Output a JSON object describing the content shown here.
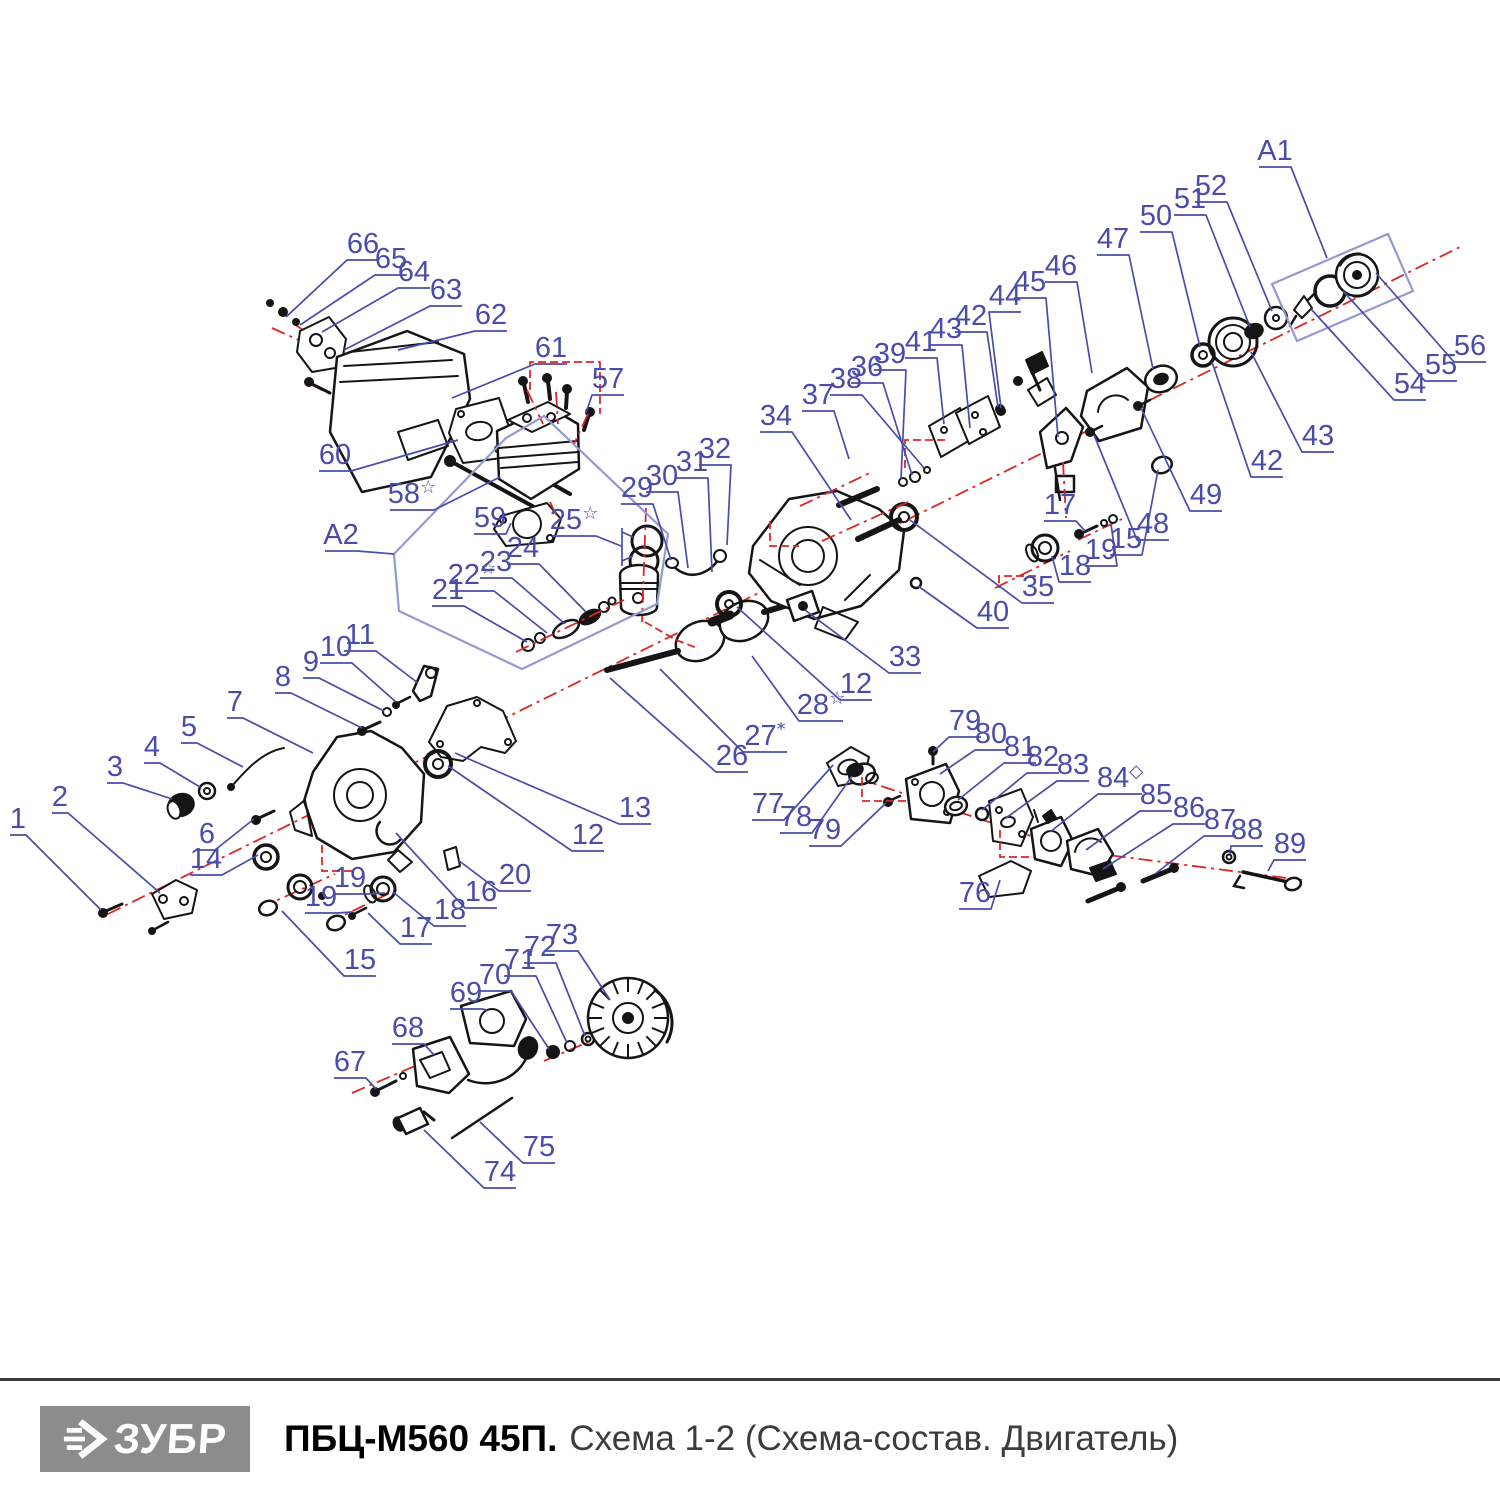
{
  "footer": {
    "brand": "ЗУБР",
    "model": "ПБЦ-М560 45П.",
    "subtitle": "Схема 1-2 (Схема-состав. Двигатель)"
  },
  "diagram": {
    "colors": {
      "label": "#4a4caa",
      "leader": "#4a4caa",
      "assembly_box": "#9599d2",
      "axis_red": "#dc2626",
      "ink": "#151515",
      "logo_bg": "#8c8c8c",
      "subtitle_gray": "#3c3c3c"
    },
    "assembly_boxes": [
      {
        "label": "A1",
        "points": "1272,284 1388,234 1413,291 1297,341"
      },
      {
        "label": "A2",
        "points": "394,554 506,438 544,416 668,534 657,604 522,669 399,611"
      }
    ],
    "axes_under": [
      "108,914 1460,247",
      "294,324 516,470",
      "272,328 336,357",
      "310,384 354,406",
      "830,769 1070,849",
      "1085,852 1302,880",
      "544,1061 667,1008",
      "352,1093 450,1051",
      "260,908 335,874",
      "328,923 400,888",
      "995,588 1070,551",
      "1078,540 1122,519"
    ],
    "axes_over": [
      "527,390 543,424",
      "556,392 558,424",
      "588,414 574,444",
      "646,508 642,622",
      "550,502 562,527",
      "516,652 624,600",
      "800,506 872,472",
      "822,541 908,502",
      "1063,462 1066,518"
    ],
    "connectors": [
      "530,390 530,362 600,362 600,414",
      "862,777 862,801 906,801",
      "1000,830 1000,857 1034,857",
      "322,845 322,871 352,871",
      "1036,576 999,576 999,588",
      "770,521 770,546 799,546",
      "645,622 676,640 697,648",
      "905,468 905,440 948,440"
    ],
    "extra_leaders": [
      "622,528 622,566",
      "622,532 633,537",
      "622,561 633,556"
    ],
    "callouts": [
      {
        "t": "1",
        "x": 18,
        "y": 828,
        "tx": 101,
        "ty": 910
      },
      {
        "t": "2",
        "x": 60,
        "y": 806,
        "tx": 160,
        "ty": 893
      },
      {
        "t": "3",
        "x": 115,
        "y": 776,
        "tx": 172,
        "ty": 799
      },
      {
        "t": "4",
        "x": 152,
        "y": 756,
        "tx": 200,
        "ty": 787
      },
      {
        "t": "5",
        "x": 189,
        "y": 736,
        "tx": 243,
        "ty": 767
      },
      {
        "t": "6",
        "x": 207,
        "y": 843,
        "tx": 254,
        "ty": 819
      },
      {
        "t": "7",
        "x": 235,
        "y": 711,
        "tx": 313,
        "ty": 753
      },
      {
        "t": "8",
        "x": 283,
        "y": 686,
        "tx": 362,
        "ty": 728
      },
      {
        "t": "9",
        "x": 311,
        "y": 671,
        "tx": 384,
        "ty": 711
      },
      {
        "t": "10",
        "x": 336,
        "y": 656,
        "tx": 396,
        "ty": 702
      },
      {
        "t": "11",
        "x": 360,
        "y": 644,
        "tx": 418,
        "ty": 683
      },
      {
        "t": "14",
        "x": 206,
        "y": 868,
        "tx": 258,
        "ty": 855
      },
      {
        "t": "15",
        "x": 360,
        "y": 969,
        "tx": 282,
        "ty": 911
      },
      {
        "t": "16",
        "x": 481,
        "y": 901,
        "tx": 396,
        "ty": 833
      },
      {
        "t": "17",
        "x": 416,
        "y": 937,
        "tx": 368,
        "ty": 913
      },
      {
        "t": "18",
        "x": 450,
        "y": 919,
        "tx": 393,
        "ty": 892
      },
      {
        "t": "19",
        "x": 350,
        "y": 887,
        "tx": 385,
        "ty": 893
      },
      {
        "t": "19",
        "x": 321,
        "y": 906,
        "tx": 352,
        "ty": 912
      },
      {
        "t": "20",
        "x": 515,
        "y": 884,
        "tx": 458,
        "ty": 860
      },
      {
        "t": "12",
        "x": 588,
        "y": 844,
        "tx": 448,
        "ty": 766
      },
      {
        "t": "13",
        "x": 635,
        "y": 817,
        "tx": 455,
        "ty": 753
      },
      {
        "t": "67",
        "x": 350,
        "y": 1071,
        "tx": 376,
        "ty": 1089
      },
      {
        "t": "68",
        "x": 408,
        "y": 1037,
        "tx": 434,
        "ty": 1055
      },
      {
        "t": "69",
        "x": 466,
        "y": 1002,
        "tx": 487,
        "ty": 1010
      },
      {
        "t": "70",
        "x": 495,
        "y": 984,
        "tx": 549,
        "ty": 1049
      },
      {
        "t": "71",
        "x": 520,
        "y": 969,
        "tx": 567,
        "ty": 1043
      },
      {
        "t": "72",
        "x": 540,
        "y": 956,
        "tx": 585,
        "ty": 1036
      },
      {
        "t": "73",
        "x": 562,
        "y": 944,
        "tx": 610,
        "ty": 1000
      },
      {
        "t": "74",
        "x": 500,
        "y": 1181,
        "tx": 424,
        "ty": 1130
      },
      {
        "t": "75",
        "x": 539,
        "y": 1156,
        "tx": 480,
        "ty": 1122
      },
      {
        "t": "66",
        "x": 363,
        "y": 253,
        "tx": 286,
        "ty": 317
      },
      {
        "t": "65",
        "x": 391,
        "y": 268,
        "tx": 300,
        "ty": 325
      },
      {
        "t": "64",
        "x": 414,
        "y": 281,
        "tx": 322,
        "ty": 332
      },
      {
        "t": "63",
        "x": 446,
        "y": 299,
        "tx": 344,
        "ty": 350
      },
      {
        "t": "62",
        "x": 491,
        "y": 324,
        "tx": 398,
        "ty": 350
      },
      {
        "t": "61",
        "x": 551,
        "y": 357,
        "tx": 452,
        "ty": 398
      },
      {
        "t": "57",
        "x": 608,
        "y": 388,
        "tx": 586,
        "ty": 413
      },
      {
        "t": "60",
        "x": 335,
        "y": 464,
        "tx": 458,
        "ty": 440
      },
      {
        "t": "58",
        "x": 412,
        "y": 503,
        "sfx": "☆",
        "tx": 500,
        "ty": 477
      },
      {
        "t": "59",
        "x": 490,
        "y": 527,
        "tx": 511,
        "ty": 523
      },
      {
        "t": "A2",
        "x": 341,
        "y": 544,
        "tx": 394,
        "ty": 554
      },
      {
        "t": "25",
        "x": 574,
        "y": 529,
        "sfx": "☆",
        "tx": 621,
        "ty": 546
      },
      {
        "t": "24",
        "x": 523,
        "y": 557,
        "tx": 586,
        "ty": 612
      },
      {
        "t": "23",
        "x": 496,
        "y": 571,
        "tx": 565,
        "ty": 624
      },
      {
        "t": "22",
        "x": 472,
        "y": 584,
        "sfx": "☆",
        "tx": 547,
        "ty": 633
      },
      {
        "t": "21",
        "x": 448,
        "y": 599,
        "tx": 527,
        "ty": 642
      },
      {
        "t": "29",
        "x": 637,
        "y": 497,
        "tx": 671,
        "ty": 560
      },
      {
        "t": "30",
        "x": 662,
        "y": 485,
        "tx": 688,
        "ty": 568
      },
      {
        "t": "31",
        "x": 692,
        "y": 471,
        "tx": 712,
        "ty": 572
      },
      {
        "t": "32",
        "x": 715,
        "y": 458,
        "tx": 727,
        "ty": 545
      },
      {
        "t": "34",
        "x": 776,
        "y": 425,
        "tx": 851,
        "ty": 520
      },
      {
        "t": "37",
        "x": 818,
        "y": 404,
        "tx": 849,
        "ty": 459
      },
      {
        "t": "38",
        "x": 846,
        "y": 388,
        "tx": 924,
        "ty": 468
      },
      {
        "t": "36",
        "x": 867,
        "y": 376,
        "tx": 912,
        "ty": 475
      },
      {
        "t": "39",
        "x": 890,
        "y": 363,
        "tx": 901,
        "ty": 479
      },
      {
        "t": "41",
        "x": 921,
        "y": 351,
        "tx": 944,
        "ty": 424
      },
      {
        "t": "43",
        "x": 946,
        "y": 338,
        "tx": 970,
        "ty": 428
      },
      {
        "t": "42",
        "x": 971,
        "y": 325,
        "tx": 998,
        "ty": 407
      },
      {
        "t": "44",
        "x": 1005,
        "y": 305,
        "tx": 1001,
        "ty": 408
      },
      {
        "t": "45",
        "x": 1030,
        "y": 291,
        "tx": 1058,
        "ty": 437
      },
      {
        "t": "46",
        "x": 1061,
        "y": 275,
        "tx": 1092,
        "ty": 373
      },
      {
        "t": "47",
        "x": 1113,
        "y": 248,
        "tx": 1153,
        "ty": 369
      },
      {
        "t": "50",
        "x": 1156,
        "y": 225,
        "tx": 1200,
        "ty": 347
      },
      {
        "t": "51",
        "x": 1190,
        "y": 208,
        "tx": 1250,
        "ty": 327
      },
      {
        "t": "52",
        "x": 1211,
        "y": 195,
        "tx": 1272,
        "ty": 311
      },
      {
        "t": "A1",
        "x": 1275,
        "y": 160,
        "tx": 1327,
        "ty": 258
      },
      {
        "t": "56",
        "x": 1470,
        "y": 355,
        "tx": 1376,
        "ty": 273
      },
      {
        "t": "55",
        "x": 1441,
        "y": 374,
        "tx": 1343,
        "ty": 291
      },
      {
        "t": "54",
        "x": 1410,
        "y": 393,
        "tx": 1311,
        "ty": 309
      },
      {
        "t": "43",
        "x": 1318,
        "y": 445,
        "tx": 1251,
        "ty": 352
      },
      {
        "t": "42",
        "x": 1267,
        "y": 470,
        "tx": 1212,
        "ty": 362
      },
      {
        "t": "49",
        "x": 1206,
        "y": 504,
        "tx": 1141,
        "ty": 408
      },
      {
        "t": "48",
        "x": 1153,
        "y": 533,
        "tx": 1094,
        "ty": 435
      },
      {
        "t": "15",
        "x": 1126,
        "y": 548,
        "tx": 1158,
        "ty": 470
      },
      {
        "t": "17",
        "x": 1060,
        "y": 514,
        "tx": 1085,
        "ty": 531
      },
      {
        "t": "19",
        "x": 1101,
        "y": 559,
        "tx": 1111,
        "ty": 524
      },
      {
        "t": "18",
        "x": 1075,
        "y": 575,
        "tx": 1052,
        "ty": 556
      },
      {
        "t": "35",
        "x": 1038,
        "y": 596,
        "tx": 910,
        "ty": 520
      },
      {
        "t": "40",
        "x": 993,
        "y": 621,
        "tx": 918,
        "ty": 586
      },
      {
        "t": "33",
        "x": 905,
        "y": 666,
        "tx": 805,
        "ty": 610
      },
      {
        "t": "12",
        "x": 856,
        "y": 693,
        "tx": 737,
        "ty": 607
      },
      {
        "t": "28",
        "x": 821,
        "y": 714,
        "sfx": "☆",
        "tx": 752,
        "ty": 656
      },
      {
        "t": "27",
        "x": 765,
        "y": 745,
        "sfx": "*",
        "tx": 660,
        "ty": 669
      },
      {
        "t": "26",
        "x": 732,
        "y": 765,
        "tx": 610,
        "ty": 678
      },
      {
        "t": "77",
        "x": 768,
        "y": 813,
        "tx": 833,
        "ty": 765
      },
      {
        "t": "78",
        "x": 796,
        "y": 826,
        "tx": 852,
        "ty": 776
      },
      {
        "t": "79",
        "x": 825,
        "y": 839,
        "tx": 886,
        "ty": 803
      },
      {
        "t": "79",
        "x": 965,
        "y": 730,
        "tx": 933,
        "ty": 752
      },
      {
        "t": "80",
        "x": 991,
        "y": 743,
        "tx": 940,
        "ty": 774
      },
      {
        "t": "81",
        "x": 1020,
        "y": 756,
        "tx": 958,
        "ty": 800
      },
      {
        "t": "82",
        "x": 1043,
        "y": 766,
        "tx": 982,
        "ty": 810
      },
      {
        "t": "83",
        "x": 1073,
        "y": 774,
        "tx": 1006,
        "ty": 818
      },
      {
        "t": "84",
        "x": 1120,
        "y": 787,
        "sfx": "◇",
        "tx": 1050,
        "ty": 832
      },
      {
        "t": "85",
        "x": 1156,
        "y": 804,
        "tx": 1086,
        "ty": 850
      },
      {
        "t": "86",
        "x": 1189,
        "y": 817,
        "tx": 1103,
        "ty": 869
      },
      {
        "t": "87",
        "x": 1220,
        "y": 829,
        "tx": 1155,
        "ty": 874
      },
      {
        "t": "88",
        "x": 1247,
        "y": 839,
        "tx": 1230,
        "ty": 854
      },
      {
        "t": "89",
        "x": 1290,
        "y": 853,
        "tx": 1268,
        "ty": 871
      },
      {
        "t": "76",
        "x": 975,
        "y": 902,
        "tx": 1000,
        "ty": 880
      }
    ]
  }
}
